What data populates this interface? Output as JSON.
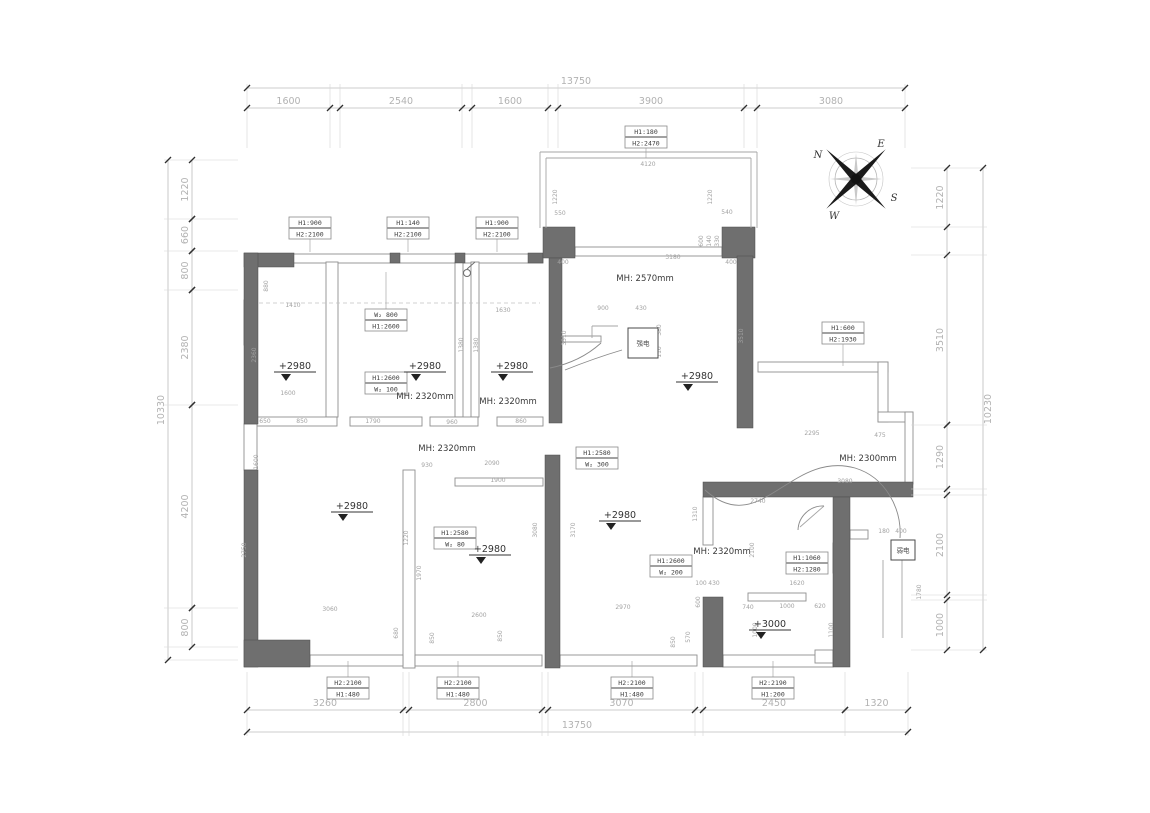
{
  "drawing": {
    "type": "floor-plan",
    "units": "mm",
    "accent_colors": {
      "wall_fill": "#6f6f6f",
      "dim_text": "#a8a8a8",
      "label_text": "#3b3b3b"
    }
  },
  "dimensions": {
    "top": {
      "overall": "13750",
      "segments": [
        "1600",
        "2540",
        "1600",
        "3900",
        "3080"
      ]
    },
    "bottom": {
      "overall": "13750",
      "segments": [
        "3260",
        "2800",
        "3070",
        "2450",
        "1320"
      ]
    },
    "left": {
      "overall": "10330",
      "segments": [
        "1220",
        "660",
        "800",
        "2380",
        "4200",
        "800"
      ]
    },
    "right": {
      "overall": "10230",
      "segments": [
        "1220",
        "3510",
        "1290",
        "2100",
        "1000"
      ]
    }
  },
  "opening_tags": [
    {
      "x": 646,
      "y": 126,
      "l1": "H1:180",
      "l2": "H2:2470",
      "ly": 158
    },
    {
      "x": 310,
      "y": 217,
      "l1": "H1:900",
      "l2": "H2:2100",
      "ly": 252
    },
    {
      "x": 408,
      "y": 217,
      "l1": "H1:140",
      "l2": "H2:2100",
      "ly": 252
    },
    {
      "x": 497,
      "y": 217,
      "l1": "H1:900",
      "l2": "H2:2100",
      "ly": 252
    },
    {
      "x": 843,
      "y": 322,
      "l1": "H1:600",
      "l2": "H2:1930",
      "ly": 366
    },
    {
      "x": 386,
      "y": 309,
      "l1": "W₂ 800",
      "l2": "H1:2600",
      "ly": 272
    },
    {
      "x": 386,
      "y": 372,
      "l1": "H1:2600",
      "l2": "W₂ 100"
    },
    {
      "x": 597,
      "y": 447,
      "l1": "H1:2580",
      "l2": "W₂ 300"
    },
    {
      "x": 455,
      "y": 527,
      "l1": "H1:2580",
      "l2": "W₂ 80"
    },
    {
      "x": 671,
      "y": 555,
      "l1": "H1:2600",
      "l2": "W₂ 200"
    },
    {
      "x": 807,
      "y": 552,
      "l1": "H1:1060",
      "l2": "H2:1280"
    },
    {
      "x": 348,
      "y": 677,
      "l1": "H2:2100",
      "l2": "H1:480",
      "ly": 661
    },
    {
      "x": 458,
      "y": 677,
      "l1": "H2:2100",
      "l2": "H1:480",
      "ly": 661
    },
    {
      "x": 632,
      "y": 677,
      "l1": "H2:2100",
      "l2": "H1:480",
      "ly": 661
    },
    {
      "x": 773,
      "y": 677,
      "l1": "H2:2190",
      "l2": "H1:200",
      "ly": 661
    }
  ],
  "level_markers": [
    {
      "x": 295,
      "y": 369,
      "value": "+2980"
    },
    {
      "x": 425,
      "y": 369,
      "value": "+2980"
    },
    {
      "x": 512,
      "y": 369,
      "value": "+2980"
    },
    {
      "x": 697,
      "y": 379,
      "value": "+2980"
    },
    {
      "x": 352,
      "y": 509,
      "value": "+2980"
    },
    {
      "x": 490,
      "y": 552,
      "value": "+2980"
    },
    {
      "x": 620,
      "y": 518,
      "value": "+2980"
    },
    {
      "x": 770,
      "y": 627,
      "value": "+3000"
    }
  ],
  "mh_labels": [
    {
      "x": 645,
      "y": 281,
      "text": "MH: 2570mm"
    },
    {
      "x": 425,
      "y": 399,
      "text": "MH: 2320mm"
    },
    {
      "x": 508,
      "y": 404,
      "text": "MH: 2320mm"
    },
    {
      "x": 447,
      "y": 451,
      "text": "MH: 2320mm"
    },
    {
      "x": 722,
      "y": 554,
      "text": "MH: 2320mm"
    },
    {
      "x": 868,
      "y": 461,
      "text": "MH: 2300mm"
    }
  ],
  "equipment": [
    {
      "x": 628,
      "y": 328,
      "w": 30,
      "h": 30,
      "label": "强电"
    },
    {
      "x": 891,
      "y": 540,
      "w": 24,
      "h": 20,
      "label": "弱电"
    }
  ],
  "compass": {
    "n": "N",
    "e": "E",
    "s": "S",
    "w": "W"
  },
  "inline_dims": [
    [
      648,
      166,
      "4120",
      0
    ],
    [
      557,
      197,
      "1220",
      1
    ],
    [
      712,
      197,
      "1220",
      1
    ],
    [
      560,
      215,
      "550",
      0
    ],
    [
      727,
      214,
      "540",
      0
    ],
    [
      673,
      259,
      "3180",
      0
    ],
    [
      563,
      264,
      "400",
      0
    ],
    [
      731,
      264,
      "400",
      0
    ],
    [
      703,
      241,
      "600",
      1
    ],
    [
      711,
      241,
      "140",
      1
    ],
    [
      719,
      241,
      "330",
      1
    ],
    [
      603,
      310,
      "900",
      0
    ],
    [
      641,
      310,
      "430",
      0
    ],
    [
      566,
      338,
      "3510",
      1
    ],
    [
      743,
      336,
      "3510",
      1
    ],
    [
      661,
      330,
      "380",
      1
    ],
    [
      661,
      352,
      "110",
      1
    ],
    [
      293,
      307,
      "1410",
      0
    ],
    [
      398,
      314,
      "2540",
      0
    ],
    [
      503,
      312,
      "1630",
      0
    ],
    [
      288,
      395,
      "1600",
      0
    ],
    [
      256,
      355,
      "2360",
      1
    ],
    [
      268,
      286,
      "880",
      1
    ],
    [
      463,
      345,
      "1380",
      1
    ],
    [
      478,
      345,
      "1380",
      1
    ],
    [
      265,
      423,
      "650",
      0
    ],
    [
      302,
      423,
      "850",
      0
    ],
    [
      373,
      423,
      "1790",
      0
    ],
    [
      452,
      424,
      "960",
      0
    ],
    [
      521,
      423,
      "860",
      0
    ],
    [
      427,
      467,
      "930",
      0
    ],
    [
      492,
      465,
      "2090",
      0
    ],
    [
      498,
      482,
      "1900",
      0
    ],
    [
      258,
      462,
      "1600",
      1
    ],
    [
      246,
      550,
      "2750",
      1
    ],
    [
      330,
      611,
      "3060",
      0
    ],
    [
      408,
      538,
      "1220",
      1
    ],
    [
      421,
      573,
      "1970",
      1
    ],
    [
      398,
      633,
      "680",
      1
    ],
    [
      434,
      638,
      "850",
      1
    ],
    [
      479,
      617,
      "2600",
      0
    ],
    [
      502,
      636,
      "850",
      1
    ],
    [
      537,
      530,
      "3080",
      1
    ],
    [
      575,
      530,
      "3170",
      1
    ],
    [
      623,
      609,
      "2970",
      0
    ],
    [
      675,
      642,
      "850",
      1
    ],
    [
      690,
      637,
      "570",
      1
    ],
    [
      700,
      602,
      "600",
      1
    ],
    [
      812,
      435,
      "2295",
      0
    ],
    [
      880,
      437,
      "475",
      0
    ],
    [
      845,
      483,
      "3080",
      0
    ],
    [
      758,
      503,
      "2740",
      0
    ],
    [
      754,
      550,
      "2100",
      1
    ],
    [
      697,
      514,
      "1310",
      1
    ],
    [
      797,
      585,
      "1620",
      0
    ],
    [
      748,
      609,
      "740",
      0
    ],
    [
      787,
      608,
      "1000",
      0
    ],
    [
      820,
      608,
      "620",
      0
    ],
    [
      757,
      630,
      "1000",
      1
    ],
    [
      833,
      630,
      "1100",
      1
    ],
    [
      701,
      585,
      "100",
      0
    ],
    [
      714,
      585,
      "430",
      0
    ],
    [
      884,
      533,
      "180",
      0
    ],
    [
      901,
      533,
      "400",
      0
    ],
    [
      921,
      592,
      "1780",
      1
    ]
  ]
}
